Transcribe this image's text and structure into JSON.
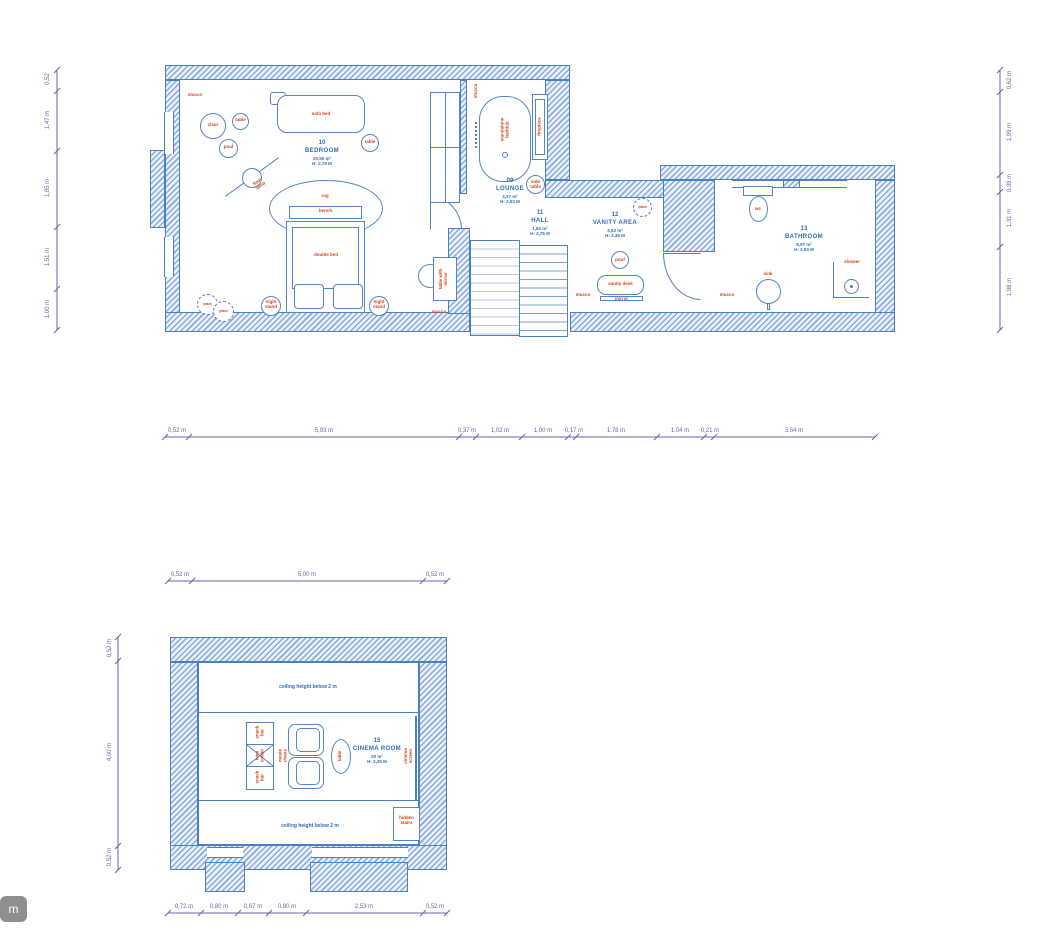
{
  "button": {
    "label": "m"
  },
  "rooms": {
    "bedroom": {
      "number": "10",
      "name": "BEDROOM",
      "area": "20,50 m²",
      "height": "H: 2,75 M"
    },
    "lounge": {
      "number": "09",
      "name": "LOUNGE",
      "area": "4,27 m²",
      "height": "H: 2,53 M"
    },
    "hall": {
      "number": "11",
      "name": "HALL",
      "area": "1,84 m²",
      "height": "H: 2,75 M"
    },
    "vanity": {
      "number": "12",
      "name": "VANITY AREA",
      "area": "3,63 m²",
      "height": "H: 2,35 M"
    },
    "bathroom": {
      "number": "13",
      "name": "BATHROOM",
      "area": "8,07 m²",
      "height": "H: 2,53 M"
    },
    "cinema": {
      "number": "15",
      "name": "CINEMA ROOM",
      "area": "20 m²",
      "height": "H: 2,35 M"
    }
  },
  "labels": {
    "stucco": "stucco",
    "chair": "chair",
    "table": "table",
    "pouf": "pouf",
    "sofa_bed": "sofa bed",
    "floor_lamp": "floor lamp",
    "rug": "rug",
    "bench": "bench",
    "double_bed": "double bed",
    "night_stand": "night stand",
    "plant": "plant",
    "table_with_mirror": "table with mirror",
    "standalone_bathtub": "standalone bathtub",
    "fireplace": "fireplace",
    "side_table": "side table",
    "vanity_desk": "vanity desk",
    "mirror": "mirror",
    "wc": "wc",
    "sink": "sink",
    "shower": "shower",
    "snack_bar": "snack bar",
    "mini_cooler": "mini cooler",
    "movie_chairs": "movie chairs",
    "cinema_screen": "cinema screen",
    "hidden_stairs": "hidden stairs",
    "ceiling_height": "ceiling height below 2 m"
  },
  "dimensions": {
    "floor1_bottom": [
      "0,52 m",
      "5,93 m",
      "0,37 m",
      "1,02 m",
      "1,00 m",
      "0,17 m",
      "1,78 m",
      "1,04 m",
      "0,21 m",
      "3,54 m"
    ],
    "floor1_left": [
      "0,52",
      "1,47 m",
      "1,85 m",
      "1,51 m",
      "1,00 m"
    ],
    "floor1_right": [
      "0,62 m",
      "1,99 m",
      "0,39 m",
      "1,31 m",
      "1,98 m"
    ],
    "floor2_top": [
      "0,52 m",
      "5,00 m",
      "0,52 m"
    ],
    "floor2_left": [
      "0,52 m",
      "4,00 m",
      "0,52 m"
    ],
    "floor2_bottom": [
      "0,72 m",
      "0,80 m",
      "0,67 m",
      "0,80 m",
      "2,53 m",
      "0,52 m"
    ]
  }
}
